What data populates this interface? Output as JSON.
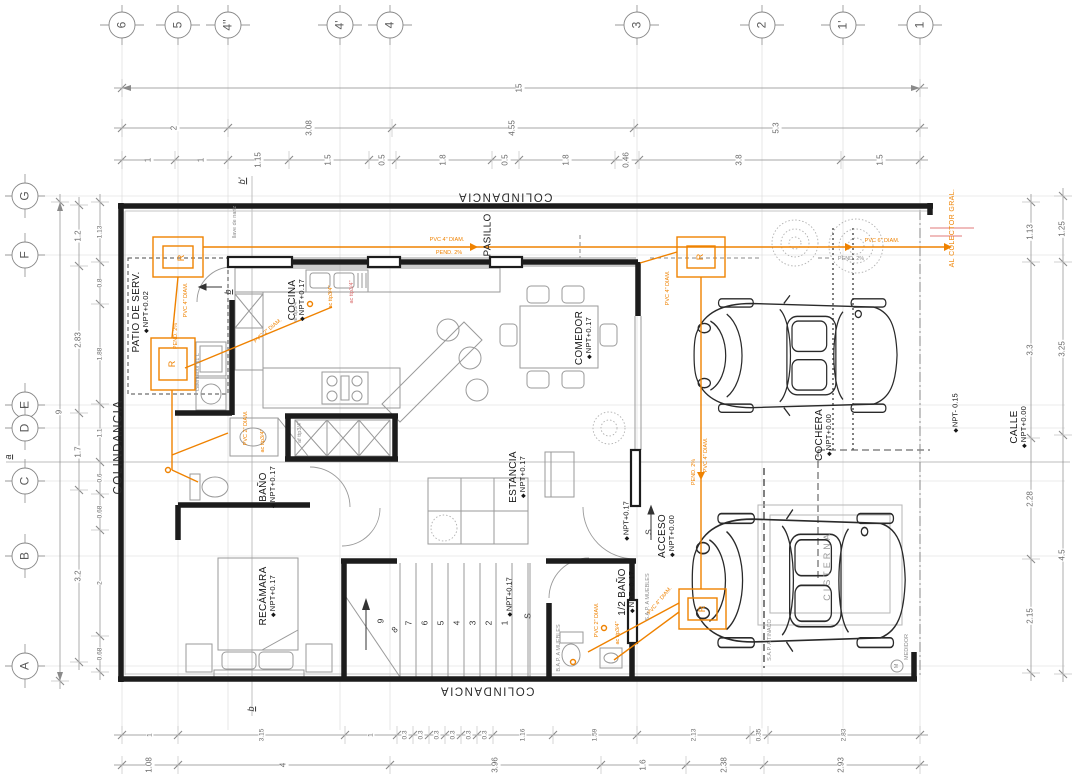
{
  "drawing": {
    "grid": {
      "top": [
        "6",
        "5",
        "4''",
        "4'",
        "4",
        "3",
        "2",
        "1'",
        "1"
      ],
      "left": [
        "G",
        "F",
        "E",
        "D",
        "C",
        "B",
        "A"
      ]
    },
    "dims": {
      "top_total": "15",
      "top_row2": [
        "2",
        "3.08",
        "4.55",
        "5.3"
      ],
      "top_row3": [
        "1",
        "1",
        "1.15",
        "1.5",
        "0.5",
        "1.8",
        "0.5",
        "1.8",
        "0.46",
        "3.8",
        "1.5"
      ],
      "bottom_row1": [
        "1",
        "3.15",
        "1",
        "0.3",
        "0.3",
        "0.3",
        "0.3",
        "0.3",
        "0.3",
        "1.16",
        "1.59",
        "2.13",
        "0.35",
        "2.83"
      ],
      "bottom_row2": [
        "1.08",
        "4",
        "3.96",
        "1.6",
        "2.38",
        "2.93"
      ],
      "left_total": "9",
      "left_outer": [
        "1.2",
        "2.83",
        "1.7",
        "3.2"
      ],
      "left_inner": [
        "1.13",
        "0.8",
        "1.88",
        "1.1",
        "0.6",
        "0.68",
        "2",
        "0.68"
      ],
      "right_inner": [
        "1.13",
        "3.3",
        "2.28",
        "2.15"
      ],
      "right_outer": [
        "1.25",
        "3.25",
        "4.5"
      ]
    },
    "rooms": {
      "patio": {
        "name": "PATIO DE SERV.",
        "npt": "NPT+0.02"
      },
      "cocina": {
        "name": "COCINA",
        "npt": "NPT+0.17"
      },
      "comedor": {
        "name": "COMEDOR",
        "npt": "NPT+0.17"
      },
      "pasillo": {
        "name": "PASILLO",
        "npt": ""
      },
      "bano": {
        "name": "BAÑO",
        "npt": "NPT+0.17"
      },
      "estancia": {
        "name": "ESTANCIA",
        "npt": "NPT+0.17"
      },
      "recamara": {
        "name": "RECÁMARA",
        "npt": "NPT+0.17"
      },
      "acceso": {
        "name": "ACCESO",
        "npt": "NPT+0.00"
      },
      "medio_bano": {
        "name": "1/2 BAÑO",
        "npt": "NPT+0.17"
      },
      "cochera": {
        "name": "COCHERA",
        "npt": "NPT+0.00"
      },
      "calle": {
        "name": "CALLE",
        "npt": "NPT+0.00"
      }
    },
    "boundaries": {
      "top": "COLINDANCIA",
      "left": "COLINDANCIA",
      "bottom": "COLINDANCIA"
    },
    "levels": {
      "npt_stairs": "NPT+0.17",
      "npt_acceso": "NPT+0.17",
      "npt_banqueta": "NPT- 0.15"
    },
    "stairs": {
      "numbers": [
        "1",
        "2",
        "3",
        "4",
        "5",
        "6",
        "7",
        "8",
        "9"
      ],
      "up": "S"
    },
    "sections": {
      "a": "a",
      "b": "b",
      "b_prime": "b'"
    },
    "equipment": {
      "cisterna": "CISTERNA",
      "medidor": "MEDIDOR",
      "medidor_m": "M",
      "calentador": "calentador 61 L",
      "llave": "llave de nariz"
    },
    "plumbing": {
      "r": "R",
      "al_colector": "AL COLECTOR GRAL.",
      "pvc4_main": "PVC 4\" DIAM.",
      "pvc6": "PVC 6\" DIAM.",
      "pvc4_vert": "PVC 4\" DIAM.",
      "pvc2": "PVC 2\" DIAM.",
      "pend2_main": "PEND. 2%",
      "pend2_right": "PEND. 2%",
      "pend2_vert": "PEND. 2%",
      "ac": "ac ttp3/4\"",
      "af": "af ttp3/4\"",
      "sap_muebles": "S.A.P. A MUEBLES",
      "bap_muebles": "B.A.P. A MUEBLES",
      "sap_tinaco": "S.A.P. A TINACO"
    },
    "colors": {
      "pipe": "#ef8200",
      "wall": "#1c1c1c",
      "dim": "#6a6a6a",
      "furniture": "#9a9a9a",
      "red": "#e07a7a"
    }
  }
}
